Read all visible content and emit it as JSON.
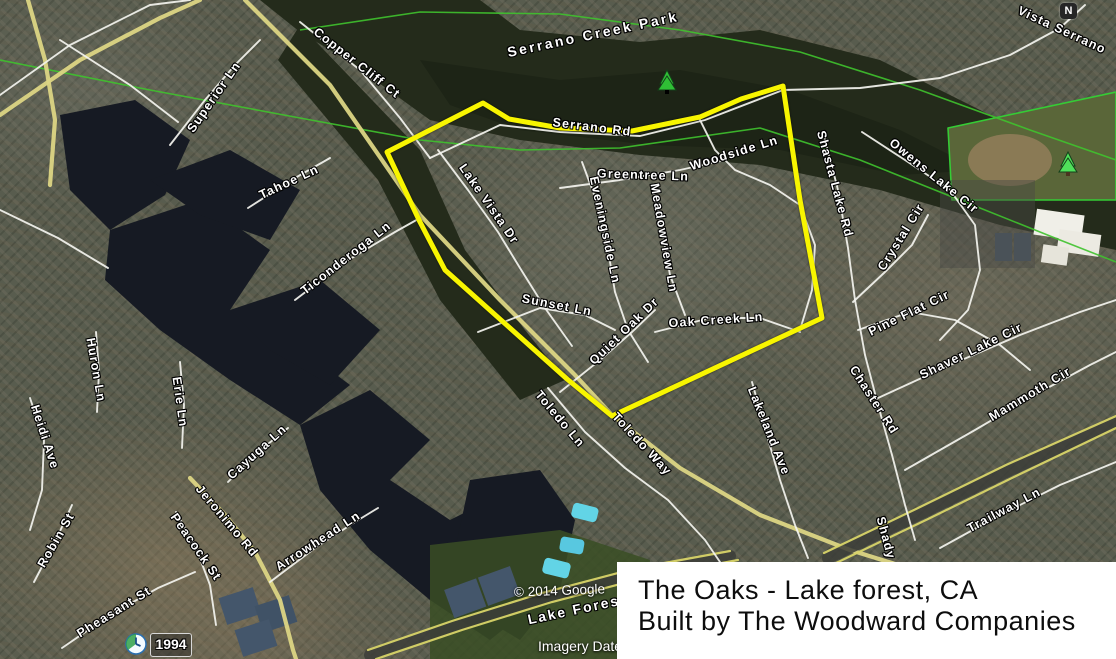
{
  "window": {
    "width": 1116,
    "height": 659
  },
  "caption": {
    "line1": "The Oaks - Lake forest, CA",
    "line2": "Built by The Woodward Companies",
    "bg": "#ffffff",
    "text_color": "#0d0d0d"
  },
  "overlays": {
    "attribution": "© 2014 Google",
    "imagery_date_label": "Imagery Date",
    "year_badge": "1994",
    "north_label": "N"
  },
  "boundary": {
    "color": "#f8f500",
    "stroke_width": 5,
    "points": "483,103 509,119 560,128 632,131 700,117 741,99 783,86 800,200 822,318 612,416 567,379 445,270 420,222 387,152"
  },
  "colors": {
    "boundary_yellow": "#f8f500",
    "water": "#161a23",
    "creek_vegetation": "#242b1b",
    "road_minor_white": "#f3f3ee",
    "road_major_yellow": "#dcd584",
    "trail_green": "#3fc22e",
    "pool_blue": "#62d4e6",
    "court_blue": "#44566b"
  },
  "street_labels": [
    {
      "text": "Superior Ln",
      "x": 214,
      "y": 97,
      "rot": -55
    },
    {
      "text": "Copper Cliff Ct",
      "x": 357,
      "y": 63,
      "rot": 38
    },
    {
      "text": "Tahoe Ln",
      "x": 289,
      "y": 182,
      "rot": -25
    },
    {
      "text": "Ticonderoga Ln",
      "x": 346,
      "y": 258,
      "rot": -38
    },
    {
      "text": "Huron Ln",
      "x": 96,
      "y": 370,
      "rot": 80
    },
    {
      "text": "Erie Ln",
      "x": 180,
      "y": 402,
      "rot": 82
    },
    {
      "text": "Heidi Ave",
      "x": 45,
      "y": 437,
      "rot": 72
    },
    {
      "text": "Cayuga Ln",
      "x": 257,
      "y": 452,
      "rot": -42
    },
    {
      "text": "Jeronimo Rd",
      "x": 227,
      "y": 521,
      "rot": 50
    },
    {
      "text": "Robin St",
      "x": 56,
      "y": 540,
      "rot": -60
    },
    {
      "text": "Peacock St",
      "x": 196,
      "y": 547,
      "rot": 55
    },
    {
      "text": "Pheasant St",
      "x": 114,
      "y": 612,
      "rot": -32
    },
    {
      "text": "Arrowhead Ln",
      "x": 318,
      "y": 541,
      "rot": -33
    },
    {
      "text": "Serrano Creek Park",
      "x": 593,
      "y": 34,
      "rot": -12,
      "cls": "park"
    },
    {
      "text": "Serrano Rd",
      "x": 592,
      "y": 127,
      "rot": 7
    },
    {
      "text": "Woodside Ln",
      "x": 734,
      "y": 153,
      "rot": -17
    },
    {
      "text": "Greentree Ln",
      "x": 643,
      "y": 175,
      "rot": 2
    },
    {
      "text": "Lake Vista Dr",
      "x": 489,
      "y": 204,
      "rot": 55
    },
    {
      "text": "Eveningside Ln",
      "x": 605,
      "y": 230,
      "rot": 78
    },
    {
      "text": "Meadowview Ln",
      "x": 664,
      "y": 238,
      "rot": 80
    },
    {
      "text": "Sunset Ln",
      "x": 557,
      "y": 305,
      "rot": 11
    },
    {
      "text": "Quiet Oak Dr",
      "x": 624,
      "y": 331,
      "rot": -44
    },
    {
      "text": "Oak Creek Ln",
      "x": 716,
      "y": 320,
      "rot": -4
    },
    {
      "text": "Toledo Ln",
      "x": 560,
      "y": 419,
      "rot": 50
    },
    {
      "text": "Toledo Way",
      "x": 642,
      "y": 444,
      "rot": 47
    },
    {
      "text": "Lakeland Ave",
      "x": 769,
      "y": 431,
      "rot": 68
    },
    {
      "text": "Shasta Lake Rd",
      "x": 835,
      "y": 184,
      "rot": 75
    },
    {
      "text": "Owens Lake Cir",
      "x": 934,
      "y": 176,
      "rot": 39
    },
    {
      "text": "Crystal Cir",
      "x": 901,
      "y": 237,
      "rot": -58
    },
    {
      "text": "Pine Flat Cir",
      "x": 909,
      "y": 313,
      "rot": -26
    },
    {
      "text": "Shaver Lake Cir",
      "x": 971,
      "y": 351,
      "rot": -26
    },
    {
      "text": "Mammoth Cir",
      "x": 1030,
      "y": 394,
      "rot": -31
    },
    {
      "text": "Chaster Rd",
      "x": 874,
      "y": 400,
      "rot": 57
    },
    {
      "text": "Trailway Ln",
      "x": 1004,
      "y": 510,
      "rot": -28
    },
    {
      "text": "Shady",
      "x": 886,
      "y": 538,
      "rot": 75
    },
    {
      "text": "Vista Serrano",
      "x": 1062,
      "y": 30,
      "rot": 25
    },
    {
      "text": "Lake Forest",
      "x": 577,
      "y": 609,
      "rot": -12,
      "cls": "road-major-label"
    }
  ]
}
